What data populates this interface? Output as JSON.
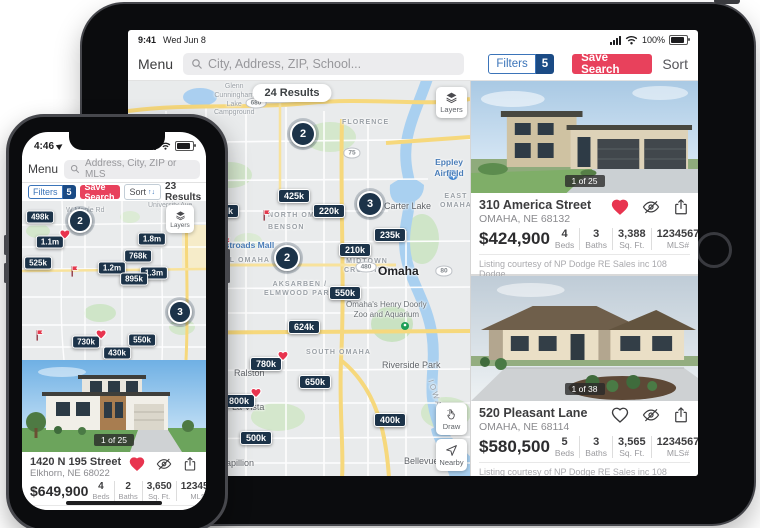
{
  "colors": {
    "accent_red": "#e8415c",
    "pin_navy": "#1c3349",
    "filters_blue": "#3b74b9",
    "badge_navy": "#1b4b85"
  },
  "tablet": {
    "status": {
      "time": "9:41",
      "date": "Wed Jun 8",
      "battery_pct": "100%"
    },
    "toolbar": {
      "menu_label": "Menu",
      "search_placeholder": "City, Address, ZIP, School...",
      "filters_label": "Filters",
      "filters_count": "5",
      "save_search_label": "Save Search",
      "sort_label": "Sort"
    },
    "map": {
      "results_label": "24 Results",
      "layers_label": "Layers",
      "draw_label": "Draw",
      "nearby_label": "Nearby",
      "price_pins": [
        {
          "label": "425k",
          "x": 166,
          "y": 115
        },
        {
          "label": "350k",
          "x": 95,
          "y": 130
        },
        {
          "label": "220k",
          "x": 201,
          "y": 130
        },
        {
          "label": "235k",
          "x": 262,
          "y": 154
        },
        {
          "label": "210k",
          "x": 227,
          "y": 169
        },
        {
          "label": "550k",
          "x": 217,
          "y": 212
        },
        {
          "label": "624k",
          "x": 176,
          "y": 246
        },
        {
          "label": "780k",
          "x": 138,
          "y": 283,
          "heart": true
        },
        {
          "label": "650k",
          "x": 187,
          "y": 301
        },
        {
          "label": "800k",
          "x": 111,
          "y": 320,
          "heart": true
        },
        {
          "label": "400k",
          "x": 262,
          "y": 339
        },
        {
          "label": "500k",
          "x": 128,
          "y": 357
        }
      ],
      "cluster_pins": [
        {
          "label": "2",
          "x": 175,
          "y": 53
        },
        {
          "label": "3",
          "x": 242,
          "y": 123
        },
        {
          "label": "2",
          "x": 159,
          "y": 177
        }
      ],
      "flags": [
        {
          "x": 139,
          "y": 134
        },
        {
          "x": 99,
          "y": 162
        }
      ],
      "labels": [
        {
          "text": "Glenn\nCunningham\nLake\nCampground",
          "x": 86,
          "y": 2,
          "type": "poi-gray"
        },
        {
          "text": "FLORENCE",
          "x": 214,
          "y": 38,
          "type": "district"
        },
        {
          "text": "Eppley Airfield",
          "x": 300,
          "y": 76,
          "type": "poi-blue"
        },
        {
          "text": "EAST OMAHA",
          "x": 312,
          "y": 112,
          "type": "district"
        },
        {
          "text": "Carter Lake",
          "x": 256,
          "y": 120,
          "type": "town"
        },
        {
          "text": "NORTH OMAHA",
          "x": 140,
          "y": 131,
          "type": "district"
        },
        {
          "text": "BENSON",
          "x": 140,
          "y": 143,
          "type": "district"
        },
        {
          "text": "Westroads Mall",
          "x": 84,
          "y": 159,
          "type": "poi-blue"
        },
        {
          "text": "CENTRAL OMAHA",
          "x": 66,
          "y": 176,
          "type": "district"
        },
        {
          "text": "MIDTOWN\nCROSSING",
          "x": 216,
          "y": 177,
          "type": "district"
        },
        {
          "text": "Omaha",
          "x": 250,
          "y": 183,
          "type": "city"
        },
        {
          "text": "AKSARBEN /\nELMWOOD PARK",
          "x": 136,
          "y": 200,
          "type": "district"
        },
        {
          "text": "Omaha's Henry Doorly\nZoo and Aquarium",
          "x": 218,
          "y": 219,
          "type": "poi-gray2"
        },
        {
          "text": "SOUTH OMAHA",
          "x": 178,
          "y": 268,
          "type": "district"
        },
        {
          "text": "Riverside Park",
          "x": 254,
          "y": 279,
          "type": "town"
        },
        {
          "text": "Ralston",
          "x": 106,
          "y": 287,
          "type": "town"
        },
        {
          "text": "La Vista",
          "x": 104,
          "y": 321,
          "type": "town"
        },
        {
          "text": "IOWA",
          "x": 292,
          "y": 308,
          "type": "state"
        },
        {
          "text": "Papillion",
          "x": 92,
          "y": 377,
          "type": "town"
        },
        {
          "text": "Bellevue",
          "x": 276,
          "y": 375,
          "type": "town"
        }
      ],
      "shields": [
        {
          "label": "680",
          "x": 128,
          "y": 22
        },
        {
          "label": "75",
          "x": 224,
          "y": 72
        },
        {
          "label": "64",
          "x": 34,
          "y": 130
        },
        {
          "label": "480",
          "x": 238,
          "y": 186
        },
        {
          "label": "80",
          "x": 316,
          "y": 190
        },
        {
          "label": "275",
          "x": 44,
          "y": 287
        }
      ]
    },
    "cards": [
      {
        "address": "310 America Street",
        "city_line": "OMAHA, NE 68132",
        "price": "$424,900",
        "photo_counter": "1 of 25",
        "favorited": true,
        "stats": [
          {
            "value": "4",
            "label": "Beds"
          },
          {
            "value": "3",
            "label": "Baths"
          },
          {
            "value": "3,388",
            "label": "Sq. Ft."
          },
          {
            "value": "1234567",
            "label": "MLS#"
          }
        ],
        "courtesy": "Listing courtesy of NP Dodge RE Sales inc 108 Dodge"
      },
      {
        "address": "520 Pleasant Lane",
        "city_line": "OMAHA, NE 68114",
        "price": "$580,500",
        "photo_counter": "1 of 38",
        "favorited": false,
        "stats": [
          {
            "value": "5",
            "label": "Beds"
          },
          {
            "value": "3",
            "label": "Baths"
          },
          {
            "value": "3,565",
            "label": "Sq. Ft."
          },
          {
            "value": "1234567",
            "label": "MLS#"
          }
        ],
        "courtesy": "Listing courtesy of NP Dodge RE Sales inc 108 Dodge"
      }
    ]
  },
  "phone": {
    "status": {
      "time": "4:46"
    },
    "toolbar": {
      "menu_label": "Menu",
      "search_placeholder": "Address, City, ZIP or MLS"
    },
    "filter_row": {
      "filters_label": "Filters",
      "filters_count": "5",
      "save_search_label": "Save Search",
      "sort_label": "Sort",
      "results_label": "23 Results"
    },
    "map": {
      "layers_label": "Layers",
      "price_pins": [
        {
          "label": "498k",
          "x": 18,
          "y": 16
        },
        {
          "label": "1.1m",
          "x": 28,
          "y": 41,
          "heart": true
        },
        {
          "label": "525k",
          "x": 16,
          "y": 62
        },
        {
          "label": "1.8m",
          "x": 130,
          "y": 38
        },
        {
          "label": "768k",
          "x": 116,
          "y": 55
        },
        {
          "label": "1.2m",
          "x": 90,
          "y": 67
        },
        {
          "label": "1.3m",
          "x": 132,
          "y": 72
        },
        {
          "label": "895k",
          "x": 112,
          "y": 78
        },
        {
          "label": "730k",
          "x": 64,
          "y": 141,
          "heart": true
        },
        {
          "label": "550k",
          "x": 120,
          "y": 139
        },
        {
          "label": "430k",
          "x": 95,
          "y": 152
        }
      ],
      "cluster_pins": [
        {
          "label": "2",
          "x": 58,
          "y": 20
        },
        {
          "label": "3",
          "x": 158,
          "y": 111
        }
      ],
      "flags": [
        {
          "x": 53,
          "y": 70
        },
        {
          "x": 18,
          "y": 134
        }
      ],
      "labels": [
        {
          "text": "W Maple Rd",
          "x": 44,
          "y": 6,
          "type": "road"
        },
        {
          "text": "University Ave",
          "x": 126,
          "y": 1,
          "type": "road"
        }
      ],
      "shields": []
    },
    "card": {
      "address": "1420 N 195 Street",
      "city_line": "Elkhorn, NE 68022",
      "price": "$649,900",
      "photo_counter": "1 of 25",
      "favorited": true,
      "stats": [
        {
          "value": "4",
          "label": "Beds"
        },
        {
          "value": "2",
          "label": "Baths"
        },
        {
          "value": "3,650",
          "label": "Sq. Ft."
        },
        {
          "value": "1234567",
          "label": "MLS#"
        }
      ],
      "courtesy": "Listing courtesy of NP Dodge RE Sales"
    }
  }
}
